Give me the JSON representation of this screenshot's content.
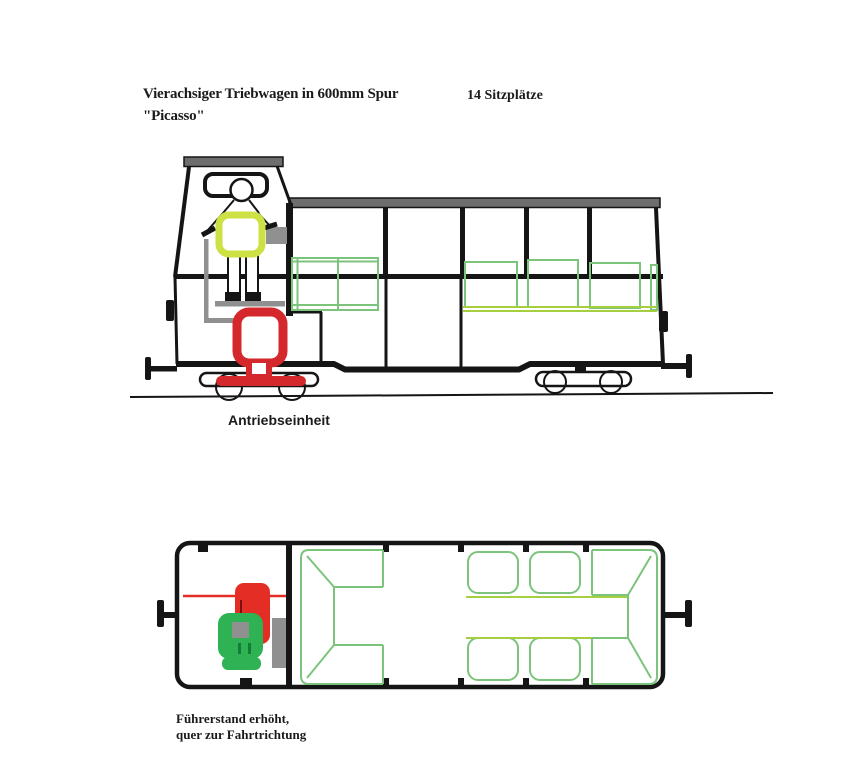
{
  "canvas": {
    "width": 848,
    "height": 768,
    "background": "#ffffff"
  },
  "labels": {
    "title_line1": "Vierachsiger Triebwagen in 600mm Spur",
    "title_line2": "\"Picasso\"",
    "capacity_note": "14 Sitzplätze",
    "drive_unit_label": "Antriebseinheit",
    "cab_note_line1": "Führerstand erhöht,",
    "cab_note_line2": "quer zur Fahrtrichtung"
  },
  "colors": {
    "paper": "#ffffff",
    "ink": "#151515",
    "roof_gray": "#6e6e6e",
    "mid_gray": "#909090",
    "red": "#d4282d",
    "red_bright": "#e42d24",
    "yellow_green": "#cde144",
    "seat_green": "#7cc47c",
    "lime_green": "#a6cf3f",
    "fill_green": "#2eb254",
    "dark_green": "#117f38"
  },
  "views": {
    "side_view": "Seitenansicht (side elevation with raised driver cab, drive unit in red, seats in green)",
    "top_view": "Grundriss (floor plan with driver seat, engine block and 14 passenger seats)"
  }
}
